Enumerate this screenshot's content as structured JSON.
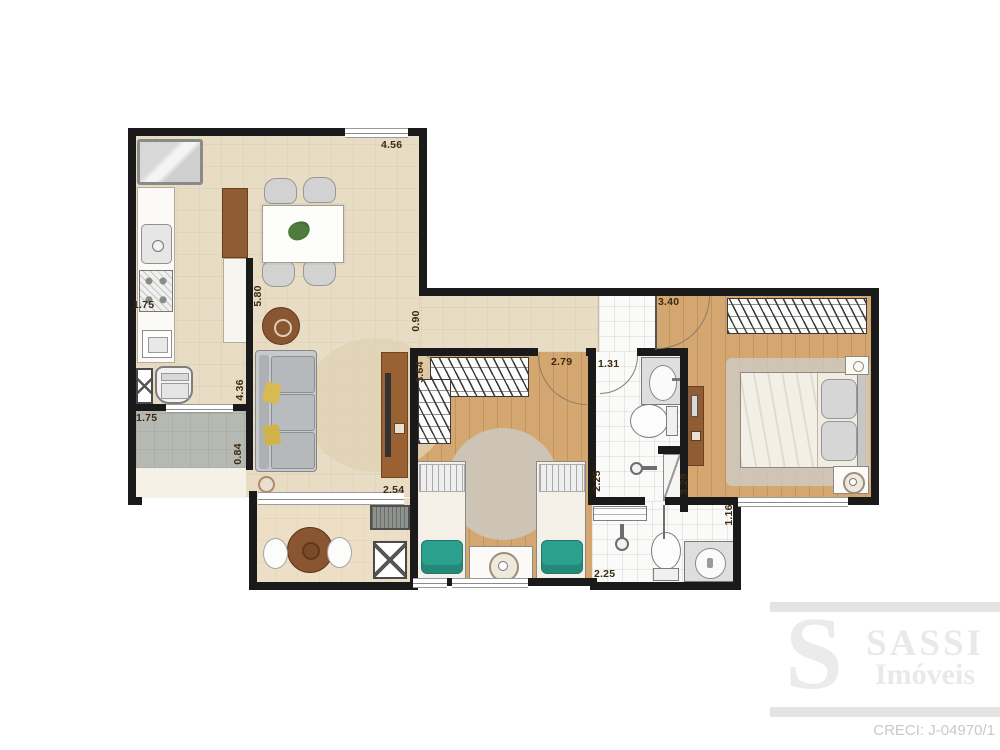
{
  "type": "apartment-floor-plan",
  "dimensions_m": {
    "kitchen_top": "4.56",
    "west_side": "5.80",
    "kitchen_counter": "1.75",
    "service_width": "1.75",
    "living_wall": "4.36",
    "service_depth": "0.84",
    "living_width": "2.54",
    "hall_width": "0.90",
    "bedroom2_depth": "3.64",
    "bedroom2_width": "2.79",
    "bath1_width": "1.31",
    "master_width": "3.40",
    "bath1_depth": "2.25",
    "master_depth": "3.29",
    "bath2_width": "2.25",
    "bath2_side": "1.16"
  },
  "watermark": {
    "logo_letter": "S",
    "brand_name": "SASSI",
    "brand_subtitle": "Imóveis",
    "license": "CRECI: J-04970/1"
  },
  "colors": {
    "wall": "#1a1a1a",
    "floor_beige": "#e8ddc4",
    "floor_wood": "#d4a771",
    "floor_service_gray": "#b6b9b2",
    "accent_wood_furniture": "#9a6233",
    "accent_teal_cushion": "#2ba08d",
    "accent_yellow_pillow": "#d7ba52",
    "watermark_gray": "#e9e9e9"
  }
}
